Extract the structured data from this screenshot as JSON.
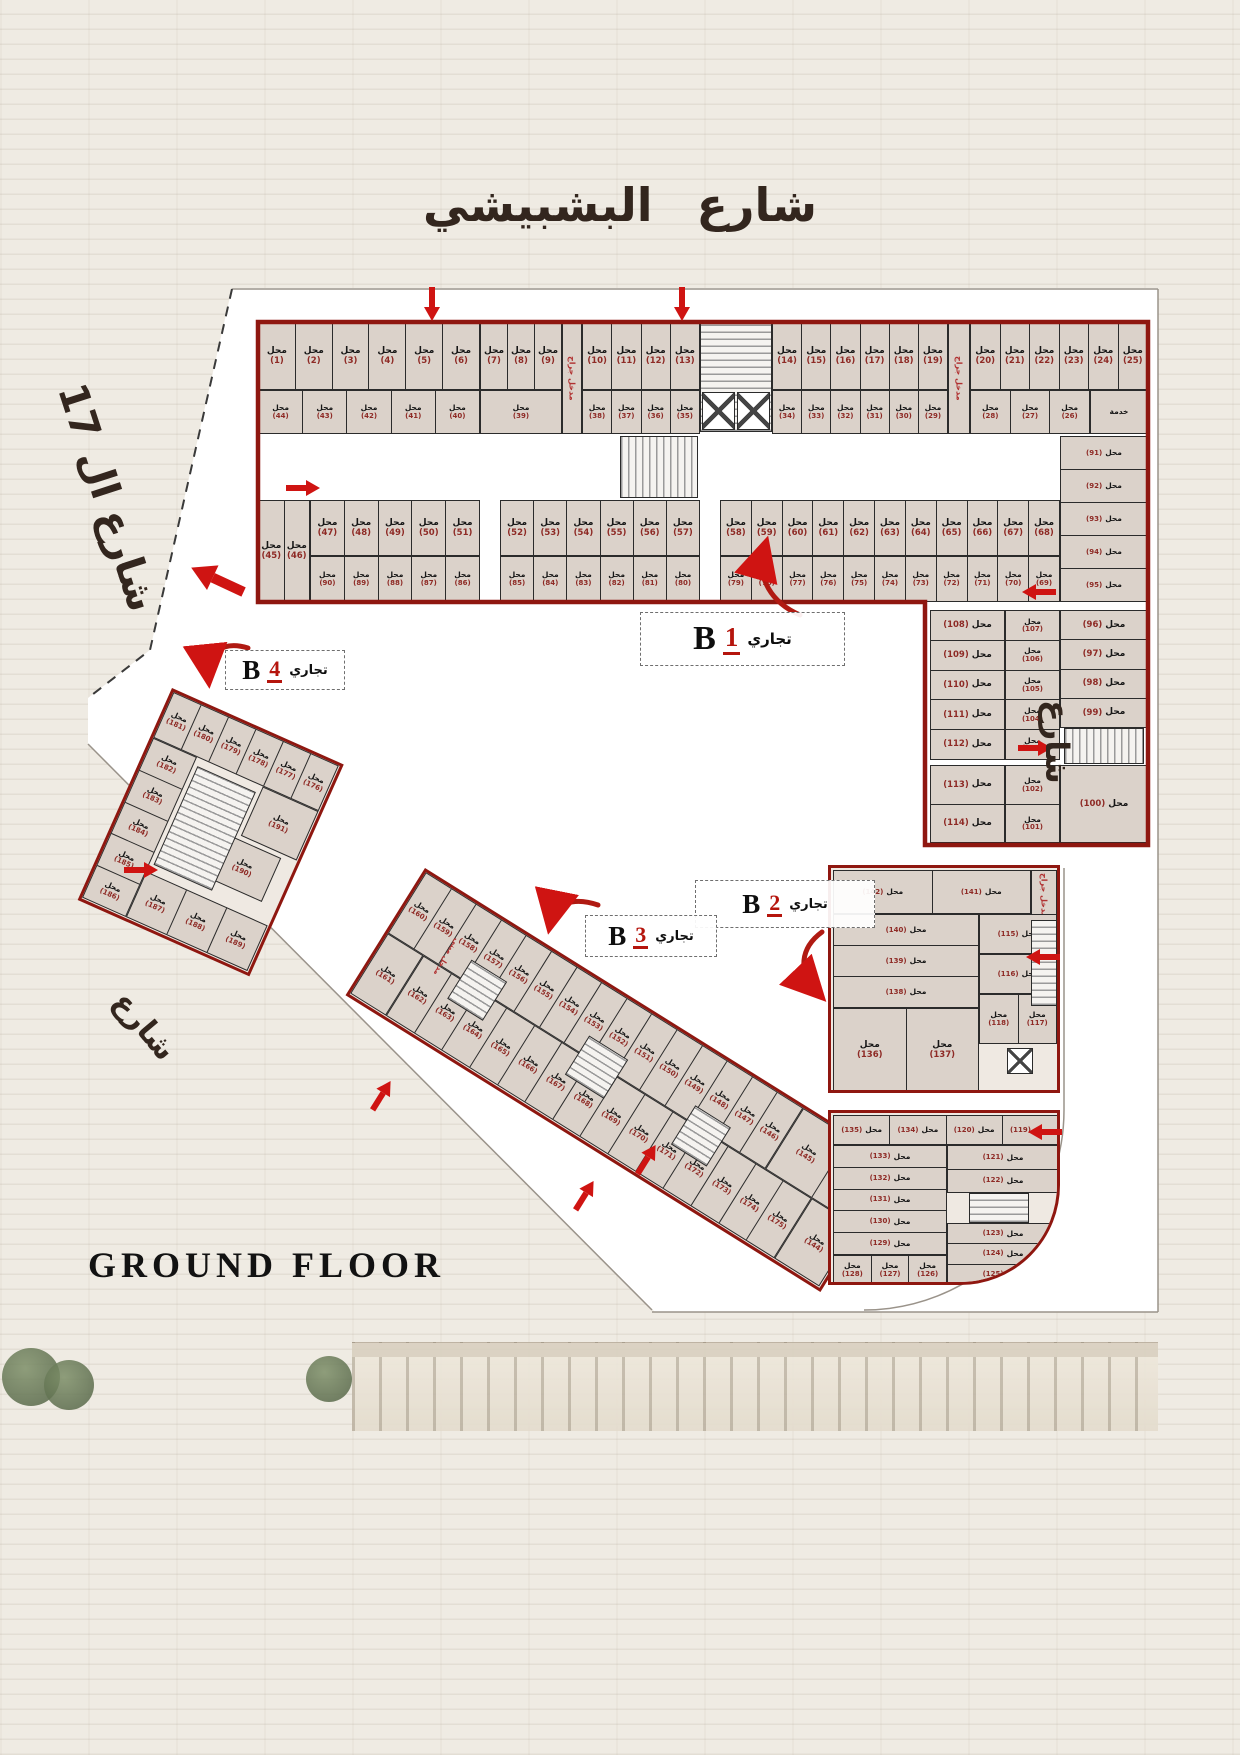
{
  "streets": {
    "top": "شارع البشبيشي",
    "left": "شارع ال 17",
    "right": "شارع",
    "bottom_left": "شارع"
  },
  "floor_title": "GROUND FLOOR",
  "labels": {
    "shop_word": "محل",
    "service_room": "خدمة",
    "garage_entrance": "مدخل جراج",
    "building_entrance": "مدخل مبنى"
  },
  "colors": {
    "outline": "#8f1710",
    "number": "#8e2a25",
    "arrow": "#cf1412",
    "cell_fill": "#dbd2ca",
    "label_red": "#b5150d"
  },
  "blocks": {
    "b1": {
      "letter": "B",
      "number": "1",
      "type_label": "تجاري",
      "row_a": [
        [
          1,
          2,
          3,
          4,
          5,
          6
        ],
        [
          7,
          8,
          9
        ],
        [
          10,
          11,
          12,
          13
        ],
        [
          14,
          15,
          16,
          17,
          18,
          19
        ],
        [
          20,
          21,
          22,
          23,
          24,
          25
        ]
      ],
      "row_b": [
        [
          44,
          43,
          42,
          41,
          40
        ],
        [
          39
        ],
        [
          38,
          37,
          36,
          35
        ],
        [
          34,
          33,
          32,
          31,
          30,
          29
        ],
        [
          28,
          27,
          26
        ]
      ],
      "row_c": [
        [
          45,
          46
        ],
        [
          47,
          48,
          49,
          50,
          51
        ],
        [
          52,
          53,
          54,
          55,
          56,
          57
        ],
        [
          58,
          59,
          60,
          61,
          62,
          63,
          64,
          65,
          66,
          67,
          68
        ]
      ],
      "row_d": [
        [
          90,
          89,
          88,
          87,
          86
        ],
        [
          85,
          84,
          83,
          82,
          81,
          80
        ],
        [
          79,
          78,
          77,
          76,
          75,
          74,
          73,
          72,
          71,
          70,
          69
        ]
      ],
      "side_column": [
        91,
        92,
        93,
        94,
        95
      ],
      "wing_left": [
        108,
        109,
        110,
        111,
        112
      ],
      "wing_left_lower": [
        113,
        114
      ],
      "wing_mid": [
        107,
        106,
        105,
        104,
        103
      ],
      "wing_mid_lower": [
        102,
        101
      ],
      "wing_right": [
        96,
        97,
        98,
        99
      ],
      "wing_right_lower": [
        100
      ]
    },
    "b2": {
      "letter": "B",
      "number": "2",
      "type_label": "تجاري",
      "upper_top": [
        142,
        141
      ],
      "upper_rows": [
        140,
        139,
        138
      ],
      "upper_right_top": [
        115
      ],
      "upper_right_mid": [
        116
      ],
      "upper_pair": [
        118,
        117
      ],
      "upper_bottom": [
        136,
        137
      ],
      "lower_top": [
        135,
        134,
        120,
        119
      ],
      "lower_left": [
        133,
        132,
        131,
        130,
        129
      ],
      "lower_right_a": [
        121,
        122
      ],
      "lower_right_b": [
        123,
        124,
        125
      ],
      "lower_bottom": [
        128,
        127,
        126
      ]
    },
    "b3": {
      "letter": "B",
      "number": "3",
      "type_label": "تجاري",
      "top_row": [
        160,
        159,
        158,
        157,
        156,
        155,
        154,
        153,
        152,
        151,
        150,
        149,
        148,
        147,
        146
      ],
      "tip_top": [
        145,
        143
      ],
      "left_cell": [
        161
      ],
      "bottom_row": [
        162,
        163,
        164,
        165,
        166,
        167,
        168,
        169,
        170,
        171,
        172,
        173,
        174,
        175
      ],
      "tip_bottom": [
        144
      ]
    },
    "b4": {
      "letter": "B",
      "number": "4",
      "type_label": "تجاري",
      "top_row": [
        181,
        180,
        179,
        178,
        177,
        176
      ],
      "left_col": [
        182,
        183,
        184,
        185,
        186
      ],
      "mid_a": [
        191
      ],
      "mid_b": [
        190
      ],
      "bottom_row": [
        187,
        188,
        189
      ]
    }
  }
}
